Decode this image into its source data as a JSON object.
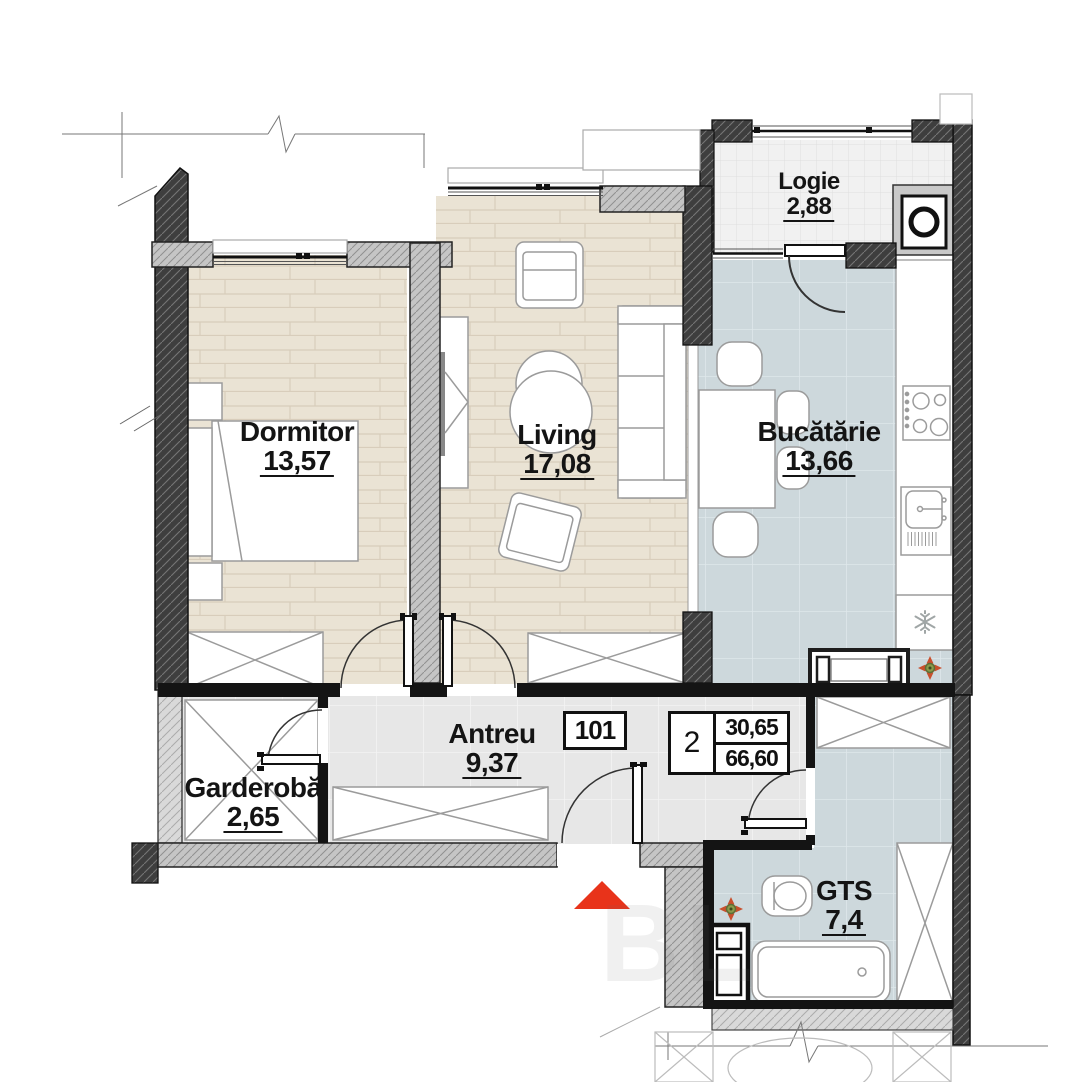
{
  "plan": {
    "apartment_number": "101",
    "unit_info": {
      "rooms": "2",
      "area_living": "30,65",
      "area_total": "66,60"
    },
    "rooms": [
      {
        "name": "Dormitor",
        "area": "13,57"
      },
      {
        "name": "Living",
        "area": "17,08"
      },
      {
        "name": "Bucătărie",
        "area": "13,66"
      },
      {
        "name": "Logie",
        "area": "2,88"
      },
      {
        "name": "Antreu",
        "area": "9,37"
      },
      {
        "name": "Garderobă",
        "area": "2,65"
      },
      {
        "name": "GTS",
        "area": "7,4"
      }
    ],
    "watermark": "BL",
    "icons": [
      "entrance-arrow-icon",
      "compass-rose-icon",
      "snowflake-icon",
      "washing-machine-icon",
      "stove-icon",
      "sink-icon",
      "bathtub-icon",
      "toilet-icon",
      "bed-icon",
      "sofa-icon",
      "wardrobe-icon"
    ],
    "colors": {
      "entrance_arrow": "#e8331a",
      "wall_dark": "#3e3e3e",
      "wall_gray": "#c5c5c5",
      "wood_floor": "#eae3d4",
      "kitchen_tile": "#cdd8dc",
      "hall_tile": "#e7e7e7",
      "logie_tile": "#f1f1f1"
    }
  }
}
